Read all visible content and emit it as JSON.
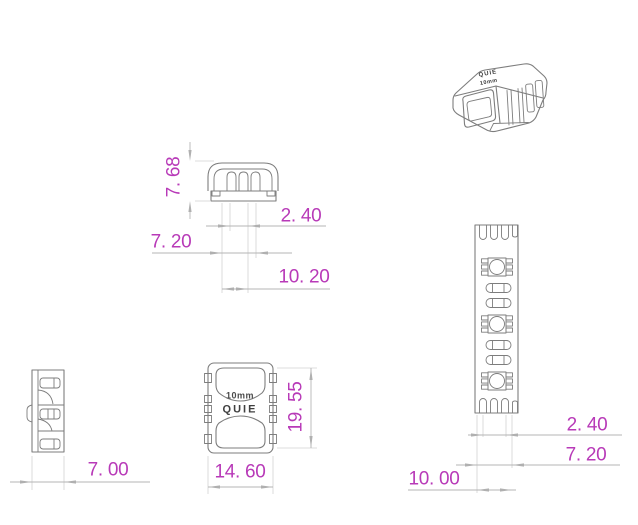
{
  "colors": {
    "dimension_text": "#b83ab8",
    "part_line": "#7d7d7d",
    "dimension_line": "#b5b5b5",
    "extension_line": "#d2d2d2"
  },
  "views": {
    "iso": {
      "brand": "QUIE",
      "size_label": "10mm"
    },
    "front": {
      "dim_height": "7. 68",
      "dim_inner": "2. 40",
      "dim_mid": "7. 20",
      "dim_outer": "10. 20"
    },
    "side": {
      "dim_width": "7. 00"
    },
    "top": {
      "size_label": "10mm",
      "brand": "QUIE",
      "dim_width": "14. 60",
      "dim_length": "19. 55"
    },
    "strip": {
      "dim_pad_gap": "2. 40",
      "dim_pad_span": "7. 20",
      "dim_width": "10. 00"
    }
  }
}
